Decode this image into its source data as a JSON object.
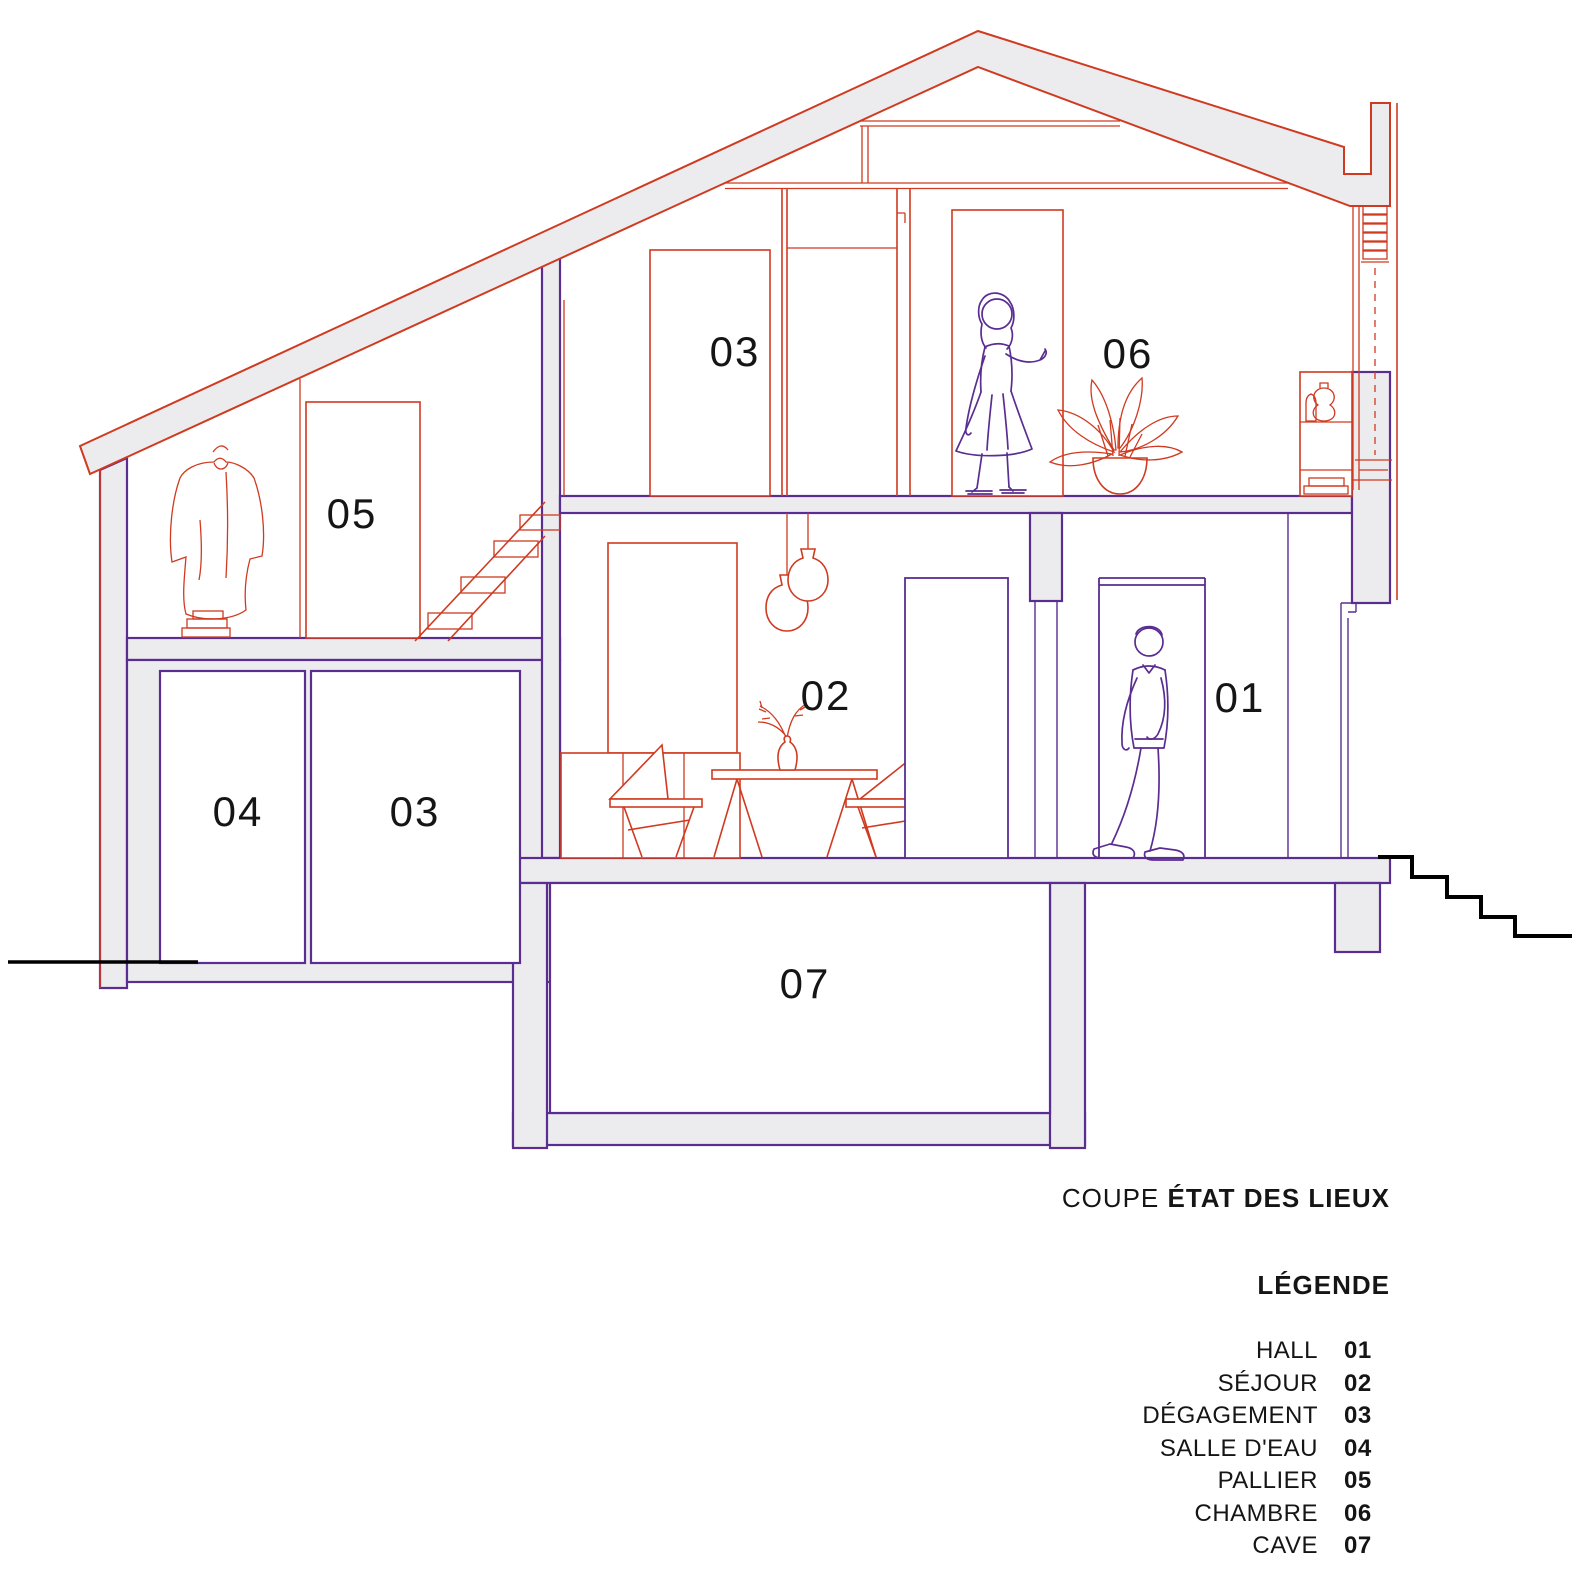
{
  "title": {
    "prefix": "COUPE ",
    "emphasis": "ÉTAT DES LIEUX"
  },
  "legend": {
    "heading": "LÉGENDE",
    "items": [
      {
        "name": "HALL",
        "code": "01"
      },
      {
        "name": "SÉJOUR",
        "code": "02"
      },
      {
        "name": "DÉGAGEMENT",
        "code": "03"
      },
      {
        "name": "SALLE D'EAU",
        "code": "04"
      },
      {
        "name": "PALLIER",
        "code": "05"
      },
      {
        "name": "CHAMBRE",
        "code": "06"
      },
      {
        "name": "CAVE",
        "code": "07"
      }
    ]
  },
  "room_labels": {
    "hall": "01",
    "sejour": "02",
    "degagement_upper": "03",
    "degagement_lower": "03",
    "salle_d_eau": "04",
    "pallier": "05",
    "chambre": "06",
    "cave": "07"
  },
  "colors": {
    "line_red": "#d03a20",
    "line_purple": "#5a2d91",
    "wall_fill": "#ececee",
    "ink": "#151515"
  }
}
